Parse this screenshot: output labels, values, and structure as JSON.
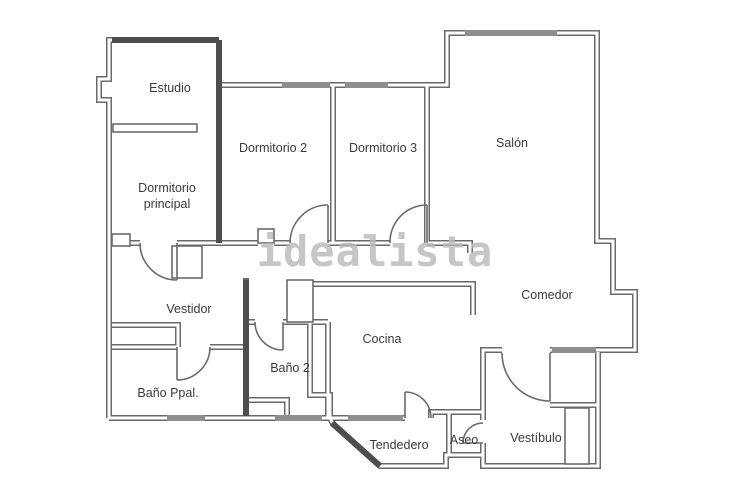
{
  "watermark": {
    "text": "idealista",
    "color": "#b8b8b8"
  },
  "colors": {
    "background": "#ffffff",
    "wall": "#6a6a6a",
    "wall_dark": "#4d4d4d",
    "wall_window_fill": "#8f8f8f",
    "label_text": "#3a3a3a"
  },
  "rooms": {
    "estudio": {
      "label": "Estudio"
    },
    "dormitorio_principal": {
      "label_line1": "Dormitorio",
      "label_line2": "principal"
    },
    "dormitorio_2": {
      "label": "Dormitorio 2"
    },
    "dormitorio_3": {
      "label": "Dormitorio 3"
    },
    "salon": {
      "label": "Salón"
    },
    "comedor": {
      "label": "Comedor"
    },
    "vestidor": {
      "label": "Vestidor"
    },
    "cocina": {
      "label": "Cocina"
    },
    "bano_ppal": {
      "label": "Baño Ppal."
    },
    "bano_2": {
      "label": "Baño 2"
    },
    "tendedero": {
      "label": "Tendedero"
    },
    "aseo": {
      "label": "Aseo"
    },
    "vestibulo": {
      "label": "Vestíbulo"
    }
  }
}
